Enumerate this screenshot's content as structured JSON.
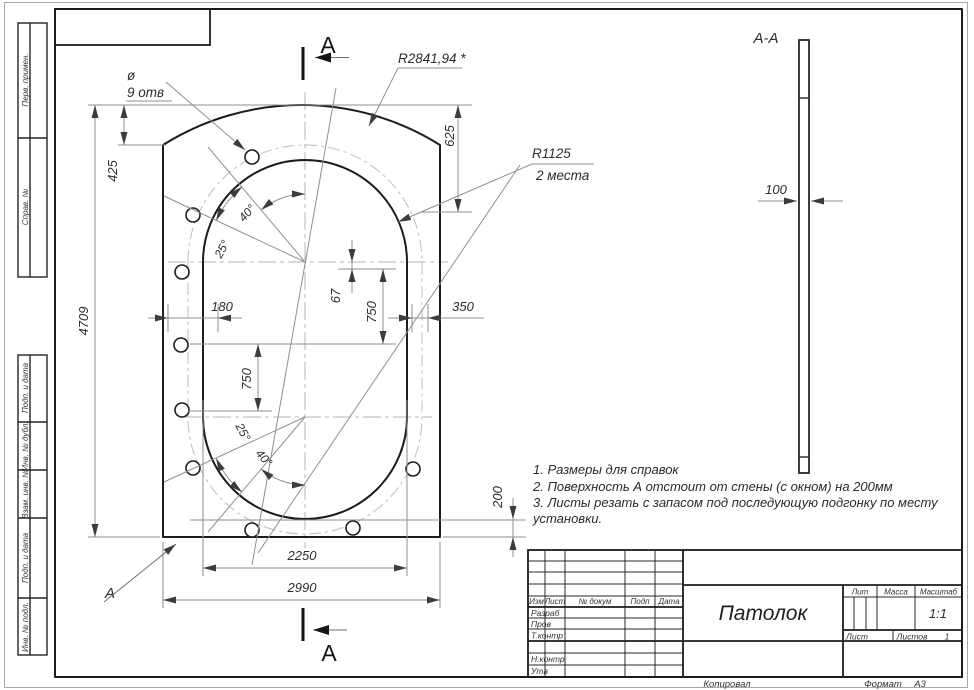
{
  "mv": {
    "dia": "ø",
    "holes": "9 отв",
    "r_arc": "R2841,94 *",
    "r_oval": "R1125",
    "r_places": "2 места",
    "d4709": "4709",
    "d425": "425",
    "d625": "625",
    "d180": "180",
    "d67": "67",
    "d750r": "750",
    "d350": "350",
    "d750l": "750",
    "d200": "200",
    "d2250": "2250",
    "d2990": "2990",
    "a40t": "40°",
    "a25t": "25°",
    "a25b": "25°",
    "a40b": "40°",
    "secA": "А",
    "surfA": "А"
  },
  "sec": {
    "title": "А-А",
    "d100": "100"
  },
  "notes": [
    "1. Размеры для справок",
    "2. Поверхность А отстоит от стены (с окном) на 200мм",
    "3. Листы резать с запасом под последующую подгонку по месту",
    "установки."
  ],
  "tb": {
    "cols": [
      "Изм",
      "Лист",
      "№ докум",
      "Подп",
      "Дата"
    ],
    "r_razrab": "Разраб",
    "r_prov": "Пров",
    "r_tkontr": "Т.контр",
    "r_nkontr": "Н.контр",
    "r_utv": "Утв",
    "title": "Патолок",
    "lit": "Лит",
    "massa": "Масса",
    "scale_l": "Масштаб",
    "scale": "1:1",
    "list": "Лист",
    "listov": "Листов",
    "listov_v": "1",
    "kopiroval": "Копировал",
    "format_l": "Формат",
    "format": "А3"
  },
  "margins": [
    "Перв. примен.",
    "Справ. №",
    "Подп. и дата",
    "Инв. № дубл.",
    "Взам. инв. №",
    "Подп. и дата",
    "Инв. № подл."
  ]
}
